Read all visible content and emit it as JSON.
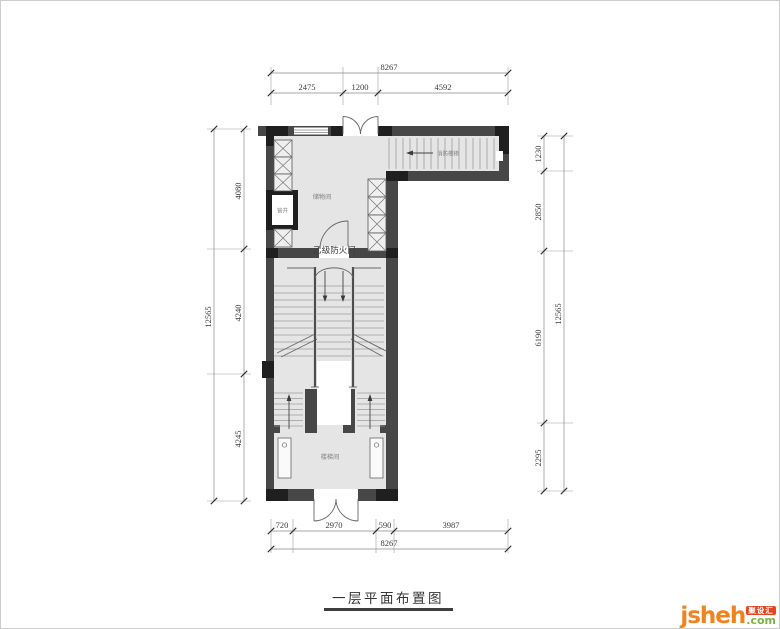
{
  "drawing": {
    "caption": "一层平面布置图",
    "labels": {
      "storage_room": "储物间",
      "pipe_shaft": "管井",
      "stair_hall": "楼梯间",
      "fire_stairs": "消防楼梯",
      "fire_door_tag": "乙级防火门"
    },
    "dimensions": {
      "top": {
        "total": "8267",
        "segments": [
          "2475",
          "1200",
          "4592"
        ]
      },
      "bottom": {
        "total": "8267",
        "segments": [
          "720",
          "2970",
          "590",
          "3987"
        ]
      },
      "left": {
        "total": "12565",
        "segments": [
          "4080",
          "4240",
          "4245"
        ]
      },
      "right": {
        "total": "12565",
        "segments": [
          "1230",
          "2850",
          "6190",
          "2295"
        ]
      }
    }
  },
  "watermark": {
    "brand": "jsheh",
    "tld": ".com",
    "badge": "聚设汇",
    "colors": {
      "brand_orange": "#f0831d",
      "tld_green": "#7cb342",
      "badge_red": "#e8431f"
    }
  }
}
